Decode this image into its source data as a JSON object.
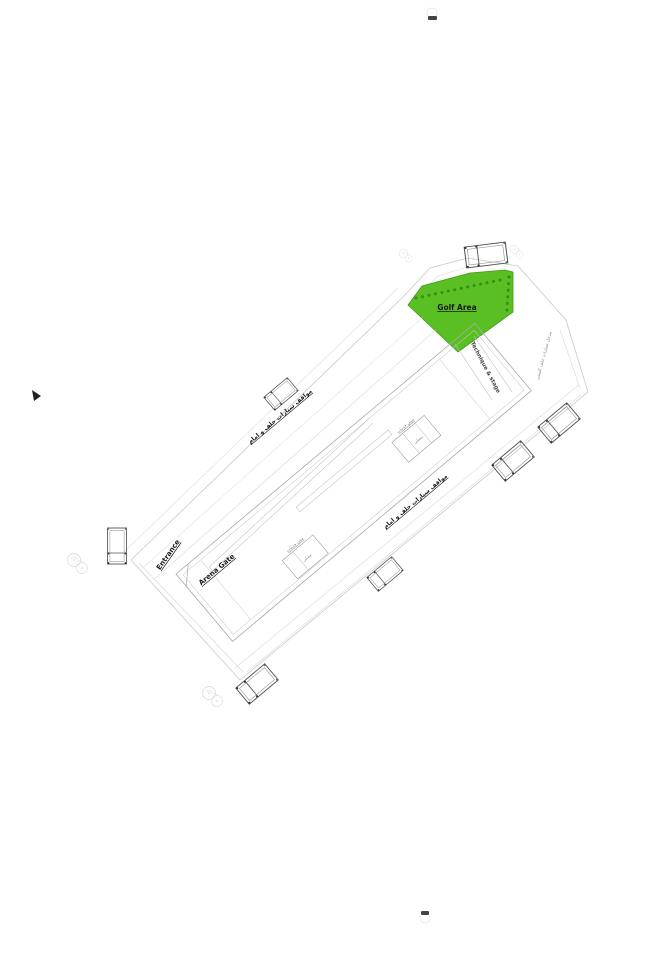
{
  "page": {
    "background": "#ffffff"
  },
  "colors": {
    "golf_fill": "#5abf23",
    "golf_edge": "#3f9a1a",
    "tree_dot": "#3a8c1a",
    "boundary_line": "#c9c9c9",
    "building_line": "#a8a8a8",
    "detail_line": "#c6c6c6",
    "truck_line": "#555555",
    "text_dark": "#1a1a1a",
    "text_muted": "#777777",
    "page_mark": "#444444"
  },
  "plan": {
    "golf_area_label": "Golf Area",
    "entrance_label": "Entrance",
    "arena_gate_label": "Arena Gate",
    "technique_stage_label": "Technique & stage",
    "parking_nw_label": "مواقف سيارات خلف و امام",
    "parking_se_label": "مواقف سيارات خلف و امام",
    "perimeter_road_label": "مدخل سيارات خلف المبنى",
    "structure_a_label": "مبنى خدمات",
    "structure_a_room_label": "مصلى",
    "structure_b_label": "مبنى خدمات",
    "structure_b_room_label": "مصلى"
  }
}
